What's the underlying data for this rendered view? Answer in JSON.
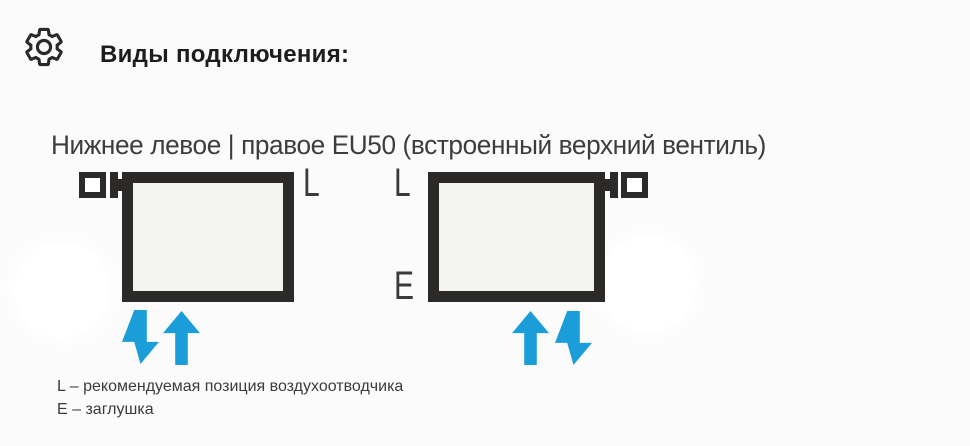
{
  "header": {
    "icon": "gear",
    "title": "Виды подключения:"
  },
  "diagram": {
    "subtitle": "Нижнее левое | правое EU50 (встроенный верхний вентиль)",
    "left_radiator": {
      "valve_position": "top-left",
      "label_l": "L",
      "arrows": [
        "down",
        "up"
      ]
    },
    "right_radiator": {
      "valve_position": "top-right",
      "label_l": "L",
      "label_e": "E",
      "arrows": [
        "up",
        "down"
      ]
    }
  },
  "legend": {
    "line1": "L – рекомендуемая позиция воздухоотводчика",
    "line2": "E – заглушка"
  },
  "colors": {
    "accent_blue": "#1b9dd9",
    "outline_dark": "#2b2a29",
    "radiator_fill": "#f3f3f2",
    "background": "#fbfbfb"
  }
}
